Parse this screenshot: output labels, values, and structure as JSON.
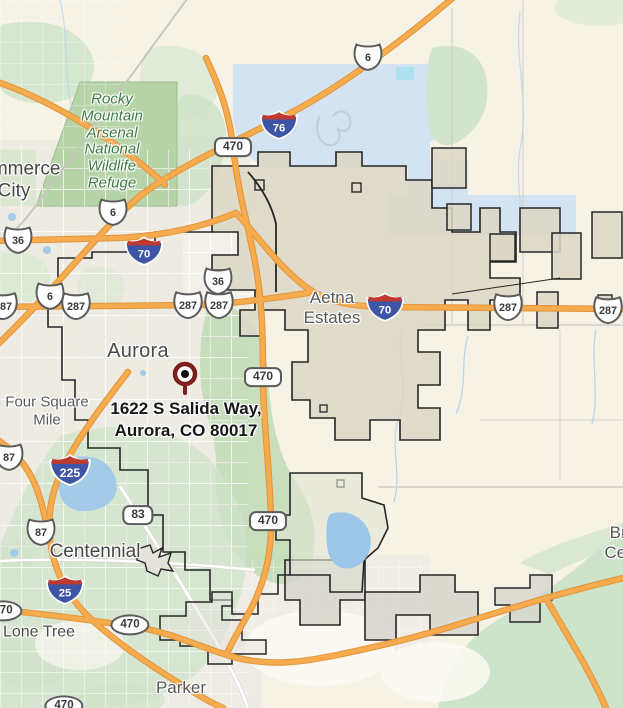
{
  "map": {
    "kind": "road-map",
    "address_marker": {
      "line1": "1622 S Salida Way,",
      "line2": "Aurora, CO 80017"
    },
    "colors": {
      "highway_orange": "#f6ab4e",
      "city_limit_fill": "#dcd7c6",
      "park_green": "#b7d4a8",
      "water_blue": "#a3cbe8",
      "airport_blue": "#d4e3f1",
      "marker_red": "#7d201c",
      "park_label_green": "#3e7c45"
    },
    "place_labels": [
      {
        "name": "commerce-city-label",
        "tier": "city",
        "x": 14,
        "y": 181,
        "lines": [
          "Commerce",
          "City"
        ]
      },
      {
        "name": "rocky-mountain-arsenal-label",
        "tier": "park",
        "x": 112,
        "y": 142,
        "lines": [
          "Rocky",
          "Mountain",
          "Arsenal",
          "National",
          "Wildlife",
          "Refuge"
        ]
      },
      {
        "name": "aurora-label",
        "tier": "city-lg",
        "x": 138,
        "y": 352,
        "lines": [
          "Aurora"
        ]
      },
      {
        "name": "aetna-estates-label",
        "tier": "locality",
        "x": 332,
        "y": 308,
        "lines": [
          "Aetna",
          "Estates"
        ]
      },
      {
        "name": "four-square-mile-label",
        "tier": "locality-sm",
        "x": 47,
        "y": 411,
        "lines": [
          "Four Square",
          "Mile"
        ]
      },
      {
        "name": "centennial-label",
        "tier": "city",
        "x": 95,
        "y": 552,
        "lines": [
          "Centennial"
        ]
      },
      {
        "name": "lone-tree-label",
        "tier": "city-sm",
        "x": 39,
        "y": 633,
        "lines": [
          "Lone Tree"
        ]
      },
      {
        "name": "parker-label",
        "tier": "locality",
        "x": 181,
        "y": 688,
        "lines": [
          "Parker"
        ]
      },
      {
        "name": "truncated-right-edge-label",
        "tier": "locality",
        "x": 620,
        "y": 543,
        "lines": [
          "Bri",
          "Cen"
        ]
      }
    ],
    "route_shields": [
      {
        "type": "us",
        "label": "6",
        "x": 368,
        "y": 57
      },
      {
        "type": "interstate",
        "label": "76",
        "x": 279,
        "y": 125
      },
      {
        "type": "us",
        "label": "6",
        "x": 113,
        "y": 212
      },
      {
        "type": "us",
        "label": "6",
        "x": 50,
        "y": 296
      },
      {
        "type": "us",
        "label": "36",
        "x": 18,
        "y": 240
      },
      {
        "type": "us",
        "label": "36",
        "x": 218,
        "y": 281
      },
      {
        "type": "interstate",
        "label": "70",
        "x": 144,
        "y": 251
      },
      {
        "type": "interstate",
        "label": "70",
        "x": 385,
        "y": 307
      },
      {
        "type": "us",
        "label": "287",
        "x": 3,
        "y": 306
      },
      {
        "type": "us",
        "label": "287",
        "x": 76,
        "y": 306
      },
      {
        "type": "us",
        "label": "287",
        "x": 188,
        "y": 305
      },
      {
        "type": "us",
        "label": "287",
        "x": 219,
        "y": 305
      },
      {
        "type": "us",
        "label": "287",
        "x": 508,
        "y": 307
      },
      {
        "type": "us",
        "label": "287",
        "x": 608,
        "y": 310
      },
      {
        "type": "pill",
        "label": "470",
        "x": 233,
        "y": 147
      },
      {
        "type": "pill",
        "label": "470",
        "x": 263,
        "y": 377
      },
      {
        "type": "pill",
        "label": "470",
        "x": 268,
        "y": 521
      },
      {
        "type": "pill",
        "label": "83",
        "x": 138,
        "y": 515
      },
      {
        "type": "us",
        "label": "87",
        "x": 9,
        "y": 457
      },
      {
        "type": "us",
        "label": "87",
        "x": 41,
        "y": 532
      },
      {
        "type": "interstate",
        "label": "225",
        "x": 70,
        "y": 470
      },
      {
        "type": "interstate",
        "label": "25",
        "x": 65,
        "y": 590
      },
      {
        "type": "oval",
        "label": "470",
        "x": 3,
        "y": 611
      },
      {
        "type": "oval",
        "label": "470",
        "x": 130,
        "y": 625
      },
      {
        "type": "oval",
        "label": "470",
        "x": 64,
        "y": 706
      }
    ]
  }
}
